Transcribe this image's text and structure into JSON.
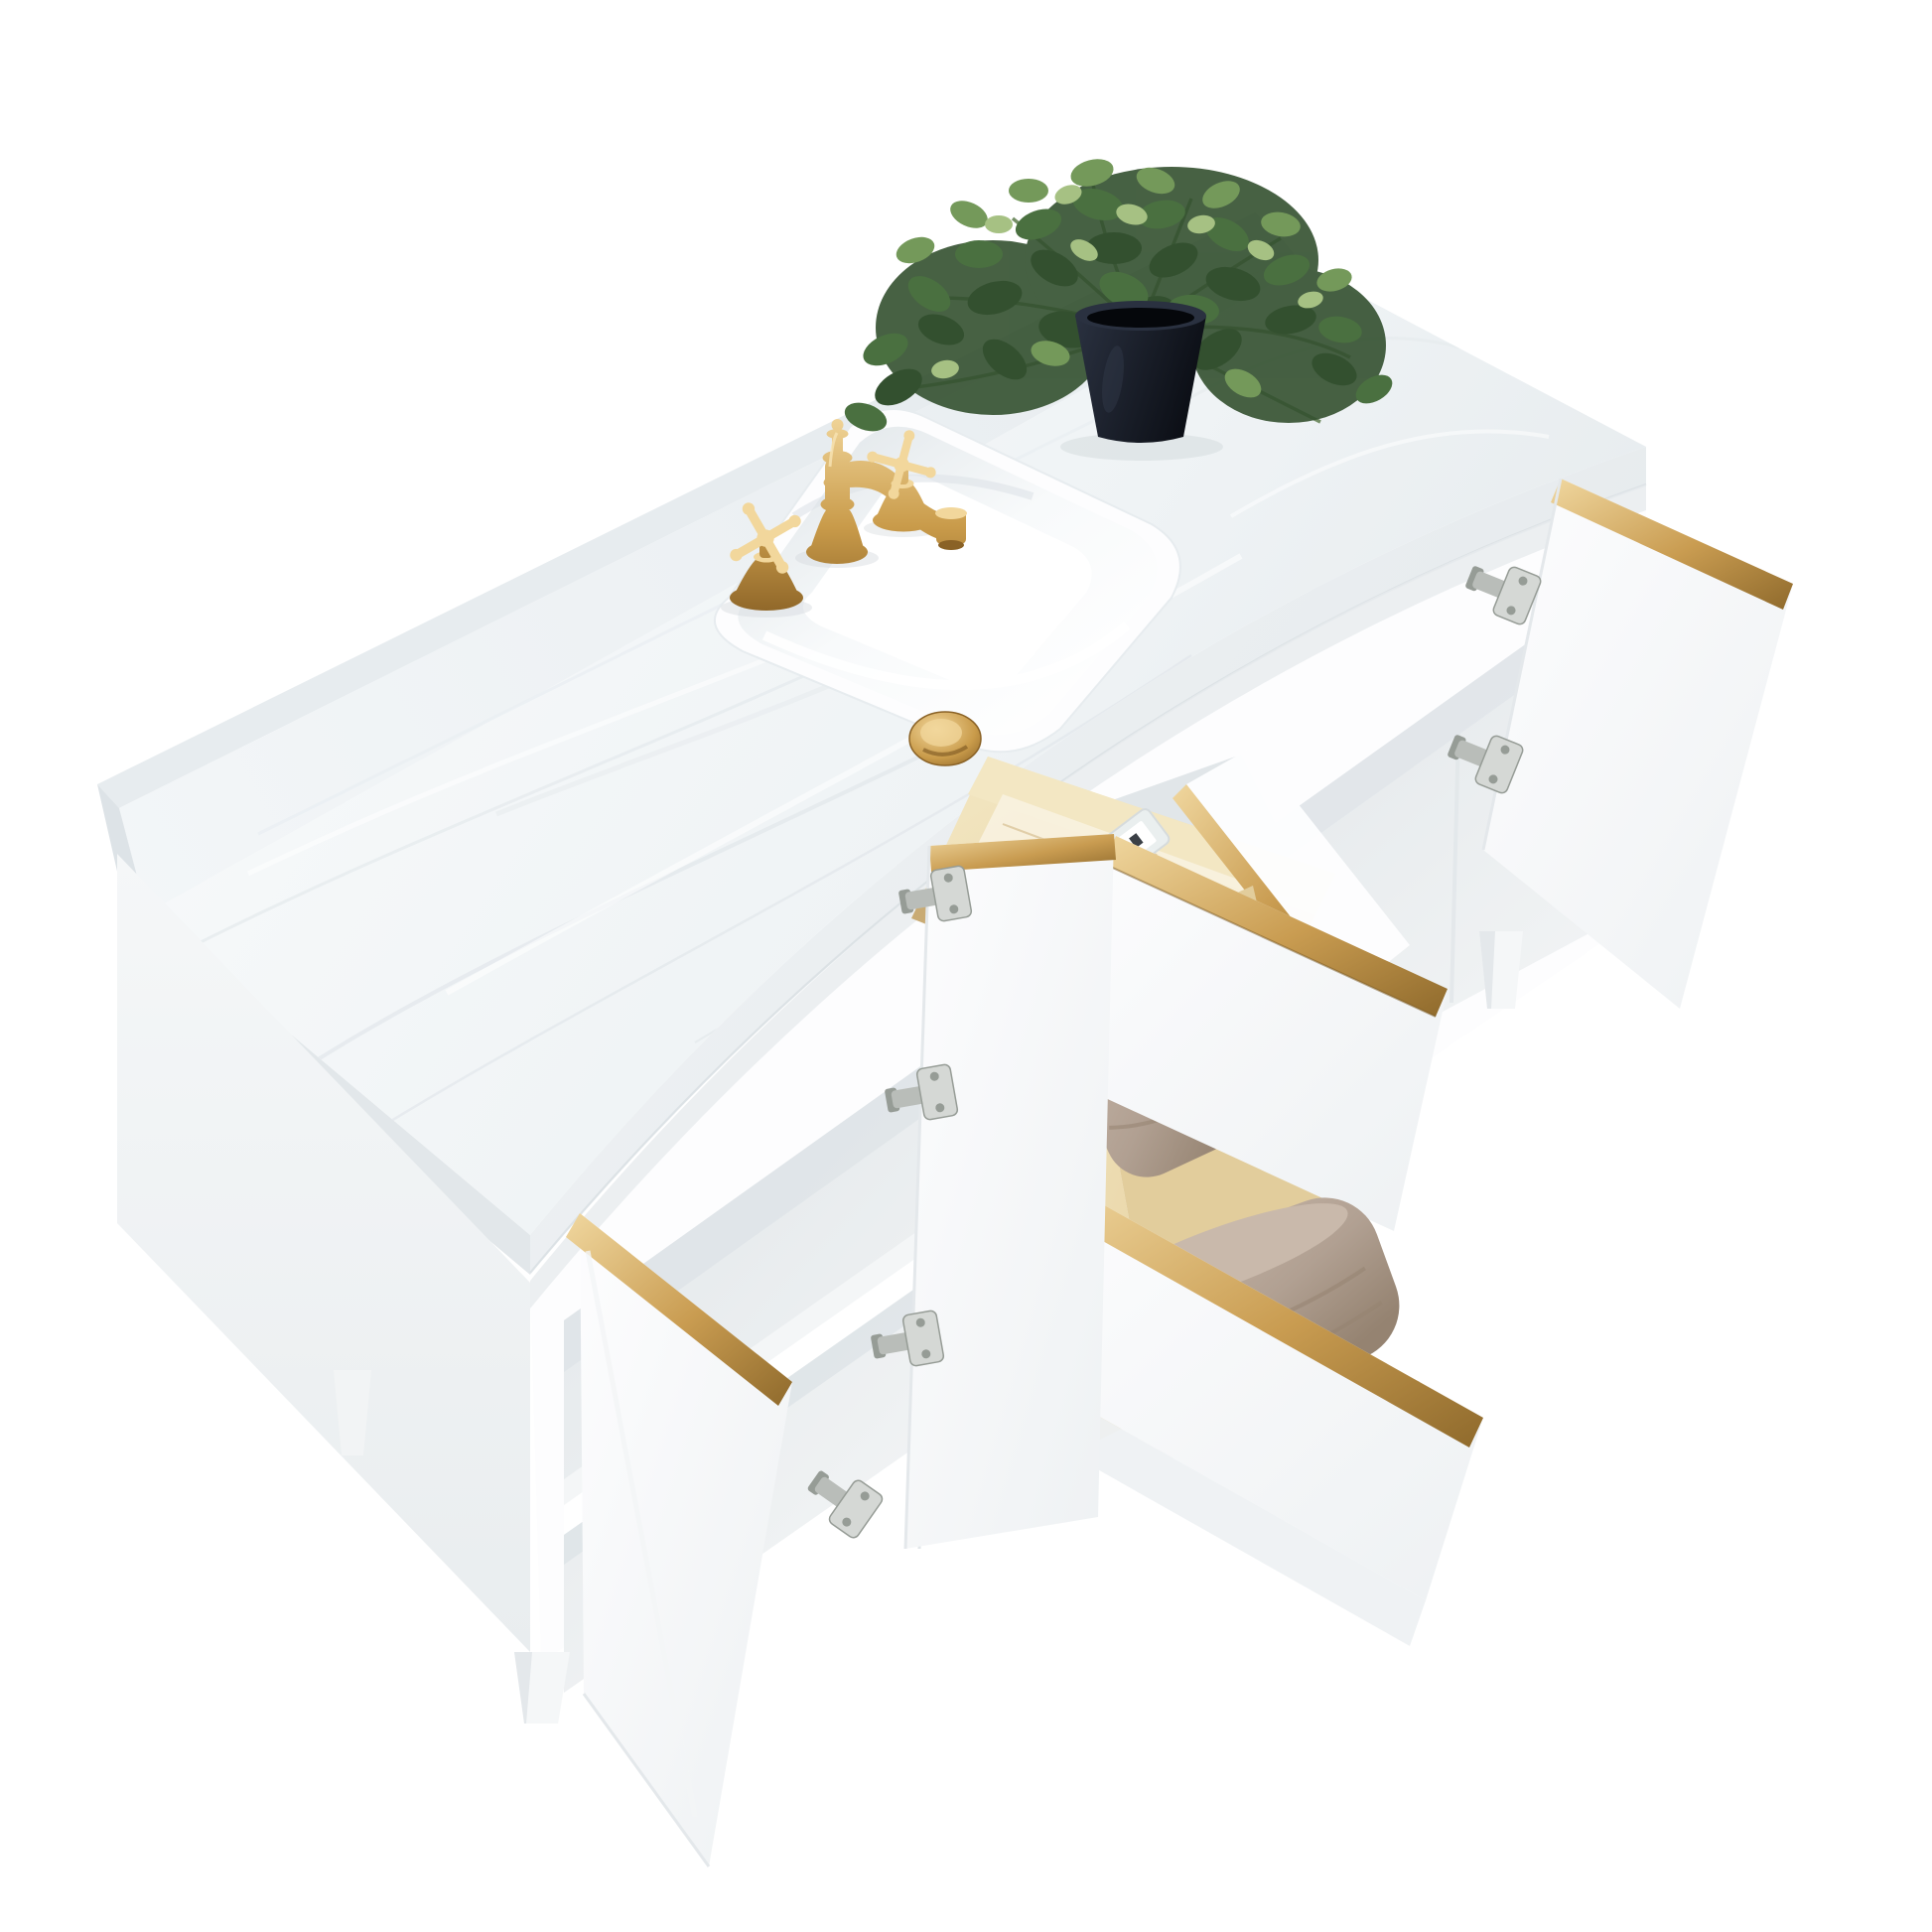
{
  "scene": {
    "type": "product-photo",
    "subject": "Freestanding white bathroom vanity viewed from above: marble countertop with backsplash, rectangular undermount sink, gold widespread cross-handle faucet, potted green plant, open doors and pulled-out drawers with gold edge trim, natural wood drawer boxes, folded taupe towels, a tip-out tray with a perfume bottle, silver concealed hinges and tapered white legs on a pure white background",
    "background": "#ffffff",
    "objects": {
      "countertop": "white engineered marble countertop",
      "backsplash": "marble backsplash strip along the back edge",
      "sink": "white rectangular undermount ceramic sink",
      "drain": "brushed gold pop-up drain cap",
      "faucet_spout": "brushed gold vintage curved spout",
      "handle_left": "gold cross handle (left)",
      "handle_right": "gold cross handle (right)",
      "plant": "green artificial eucalyptus plant",
      "pot": "black tapered planter pot",
      "cabinet_body": "white vanity cabinet",
      "left_panel": "white cabinet end panel",
      "shelf": "interior shelf of the left compartment",
      "door_left": "open cabinet door (left, gold trimmed edge)",
      "door_middle": "open cabinet door (middle, hanging)",
      "door_right": "open cabinet door (right, gold trimmed edge)",
      "tray": "tip-out pine tray",
      "bottle": "perfume bottle with navy sleeve and clear glass cap",
      "drawer_upper": "open upper drawer with towel",
      "drawer_lower": "open lower drawer with towel",
      "towel_upper": "folded taupe towel",
      "towel_lower": "folded taupe towel",
      "hinge": "nickel concealed door hinge",
      "leg": "tapered white wood leg",
      "gold_trim": "brushed gold edge trim"
    }
  },
  "colors": {
    "background": "#ffffff",
    "marble_light": "#f8fafb",
    "marble_mid": "#eff3f5",
    "marble_shadow": "#e4e9ec",
    "counter_edge_light": "#f1f4f6",
    "counter_edge_dark": "#e2e7ea",
    "splash_light": "#f3f6f8",
    "splash_dark": "#e7ecef",
    "splash_side": "#dde3e7",
    "cabinet_white": "#fdfdfe",
    "cabinet_face_shadow": "#eef1f3",
    "cabinet_side": "#f5f7f8",
    "cabinet_side_dark": "#e9edef",
    "interior_light": "#f2f4f5",
    "interior_shadow": "#e1e6e9",
    "seam": "#d9dfe3",
    "gold_light": "#f0d79f",
    "gold_mid": "#c99c51",
    "gold_dark": "#8f6a2c",
    "brass_light": "#f2d79c",
    "brass_mid": "#c99b4a",
    "brass_dark": "#8a6226",
    "wood_light": "#f3e7c3",
    "wood_mid": "#e7d2a2",
    "wood_dark": "#c9ab74",
    "towel_light": "#c9b9ab",
    "towel_mid": "#b1a092",
    "towel_dark": "#958371",
    "navy_light": "#343d58",
    "navy_dark": "#121723",
    "glass_tint": "#eaf0f3",
    "label_white": "#ffffff",
    "hinge_silver": "#d5d8d5",
    "hinge_dark": "#969c96",
    "pot_light": "#2a3140",
    "pot_dark": "#0c0f16",
    "leaf_dark": "#33502f",
    "leaf_mid": "#4a7040",
    "leaf_light": "#74995a",
    "leaf_pale": "#a6c183",
    "stem_green": "#5d7c4c"
  }
}
